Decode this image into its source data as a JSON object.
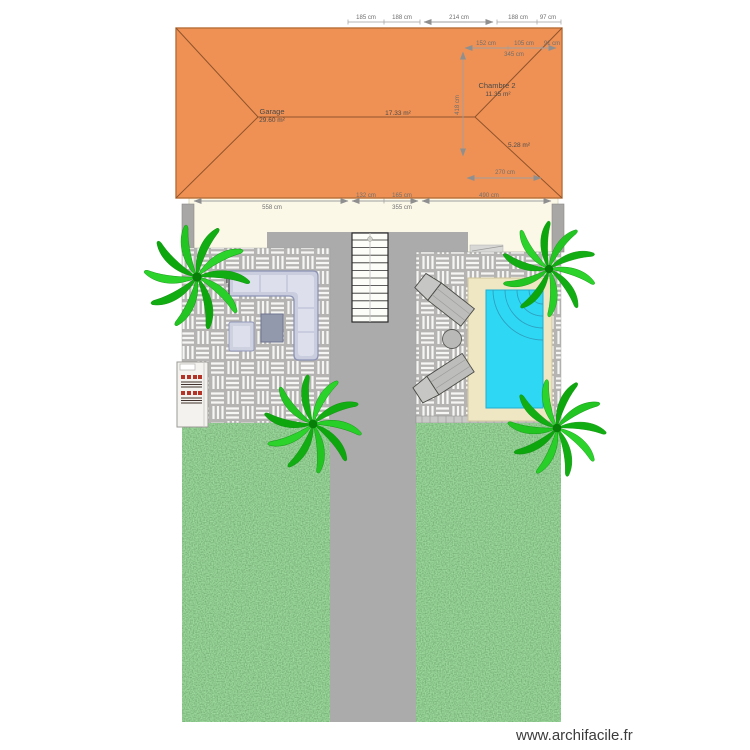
{
  "page": {
    "watermark": "www.archifacile.fr"
  },
  "plan": {
    "rooms": {
      "garage": {
        "name": "Garage",
        "area": "29.60 m²"
      },
      "living": {
        "area": "17.33 m²"
      },
      "chambre2": {
        "name": "Chambre 2",
        "area": "11.35 m²"
      },
      "small_room": {
        "area": "5.28 m²"
      }
    },
    "dimensions": {
      "top": [
        "185 cm",
        "188 cm",
        "214 cm",
        "188 cm",
        "97 cm"
      ],
      "inner_right": [
        "152 cm",
        "105 cm",
        "91 cm"
      ],
      "inner_right_total": "345 cm",
      "inner_vertical": "418 cm",
      "inner_lower_right": "270 cm",
      "bottom_left_total": "558 cm",
      "bottom_mid": [
        "132 cm",
        "165 cm"
      ],
      "bottom_mid_total": "355 cm",
      "bottom_right": "490 cm"
    },
    "colors": {
      "roof": "#ef9154",
      "roof_edge": "#a8602f",
      "house_band": "#fbf8e8",
      "wall": "#a8a7a5",
      "terrace": "#ababab",
      "tile": "#b5b4b2",
      "tile_stripe": "#f6f6f4",
      "grass": "#58a058",
      "pool_water": "#2ed8f4",
      "pool_deck": "#efe6c3",
      "sofa": "#c9cdde",
      "lounger": "#bdbdbb",
      "palm": "#22c522",
      "bbq_accent": "#b43226"
    }
  }
}
